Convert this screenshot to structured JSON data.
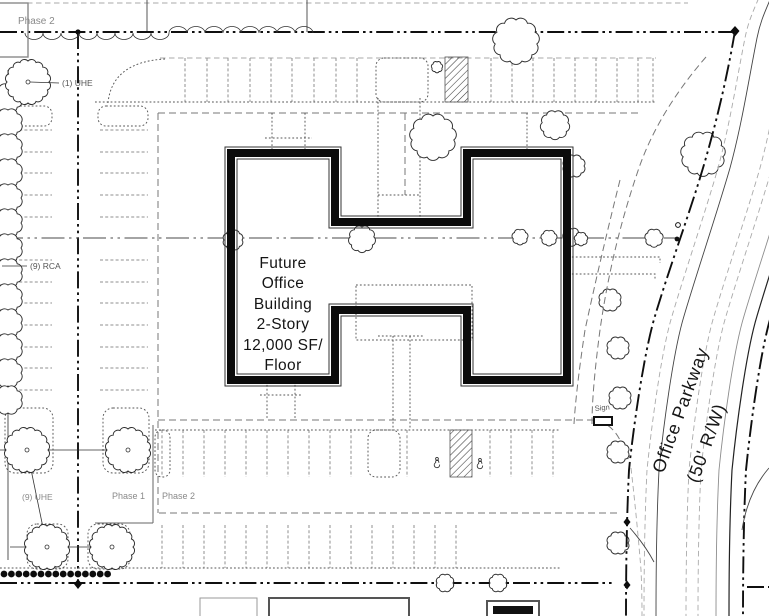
{
  "plan": {
    "building": {
      "lines": [
        "Future",
        "Office",
        "Building",
        "2-Story",
        "12,000 SF/",
        "Floor"
      ]
    },
    "road": {
      "name": "Office Parkway",
      "right_of_way": "(50' R/W)"
    },
    "phases": {
      "top": "Phase 2",
      "bottom_left": "Phase 1",
      "bottom_right": "Phase 2"
    },
    "plantings": {
      "top": "(1) UHE",
      "middle": "(9) RCA",
      "bottom": "(9) UHE"
    },
    "sign": {
      "label": "Sign"
    },
    "colors": {
      "ink": "#141414",
      "wall": "#0b0b0b",
      "stall_gray": "#8f8f8f",
      "label_gray": "#8a8a8a",
      "paper": "#ffffff"
    }
  }
}
